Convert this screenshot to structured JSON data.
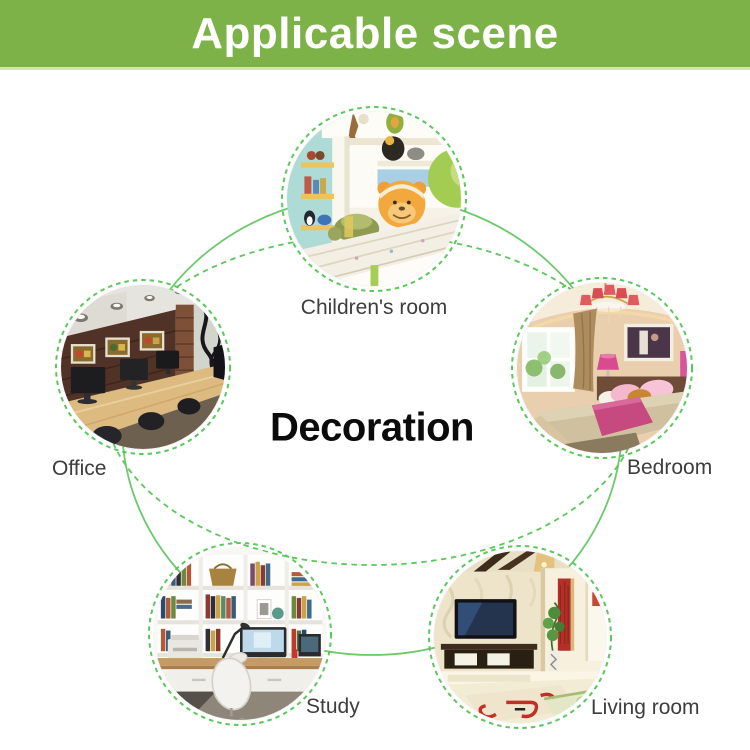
{
  "header": {
    "title": "Applicable scene"
  },
  "center": {
    "label": "Decoration"
  },
  "scenes": [
    {
      "id": "children-room",
      "label": "Children's room",
      "illustration": "children-room-photo"
    },
    {
      "id": "office",
      "label": "Office",
      "illustration": "office-photo"
    },
    {
      "id": "bedroom",
      "label": "Bedroom",
      "illustration": "bedroom-photo"
    },
    {
      "id": "study",
      "label": "Study",
      "illustration": "study-photo"
    },
    {
      "id": "living-room",
      "label": "Living room",
      "illustration": "living-room-photo"
    }
  ],
  "theme": {
    "banner-green": "#7cb247",
    "banner-edge": "#d3e6ad",
    "line-green": "#6cc96c",
    "dash-green": "#5cc75c",
    "label-color": "#3d3d3d",
    "title-white": "#ffffff",
    "center-black": "#0b0b0b",
    "page-bg": "#ffffff"
  }
}
